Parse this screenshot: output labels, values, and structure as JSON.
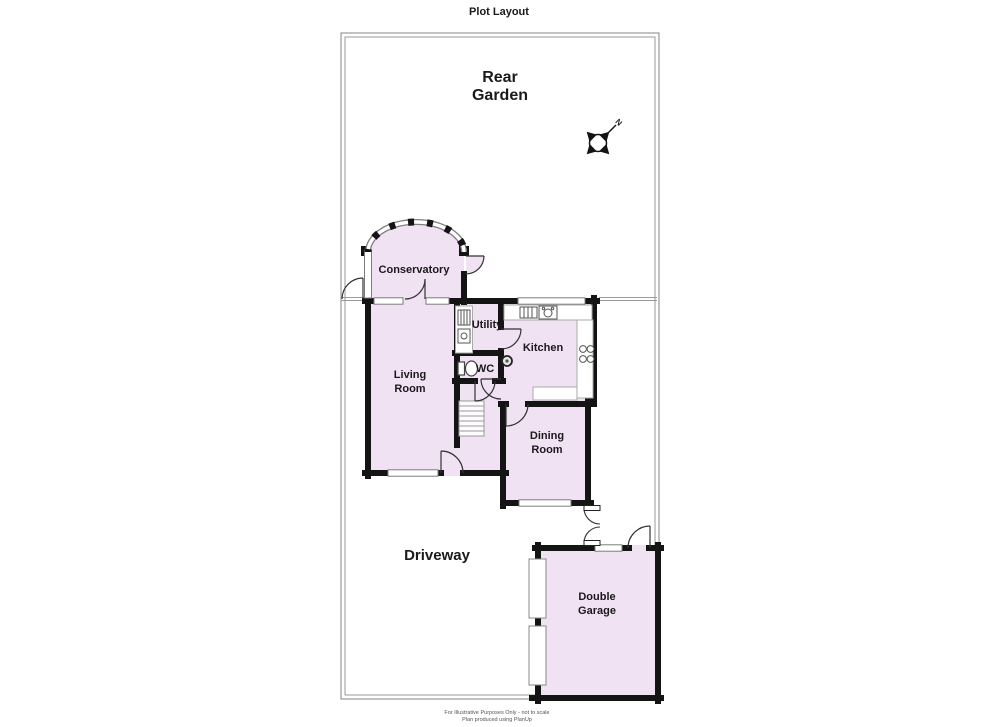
{
  "title": "Plot Layout",
  "colors": {
    "room_fill": "#F0E1F3",
    "wall": "#141414",
    "boundary": "#9A9A9A",
    "window_frame": "#7D7D7D"
  },
  "compass": {
    "north_label": "N"
  },
  "areas": {
    "rear_garden_line1": "Rear",
    "rear_garden_line2": "Garden",
    "driveway": "Driveway"
  },
  "rooms": {
    "conservatory": "Conservatory",
    "living_room_line1": "Living",
    "living_room_line2": "Room",
    "utility": "Utility",
    "kitchen": "Kitchen",
    "wc": "WC",
    "dining_room_line1": "Dining",
    "dining_room_line2": "Room",
    "garage_line1": "Double",
    "garage_line2": "Garage"
  },
  "footer": {
    "line1": "For Illustrative Purposes Only - not to scale",
    "line2": "Plan produced using PlanUp"
  }
}
